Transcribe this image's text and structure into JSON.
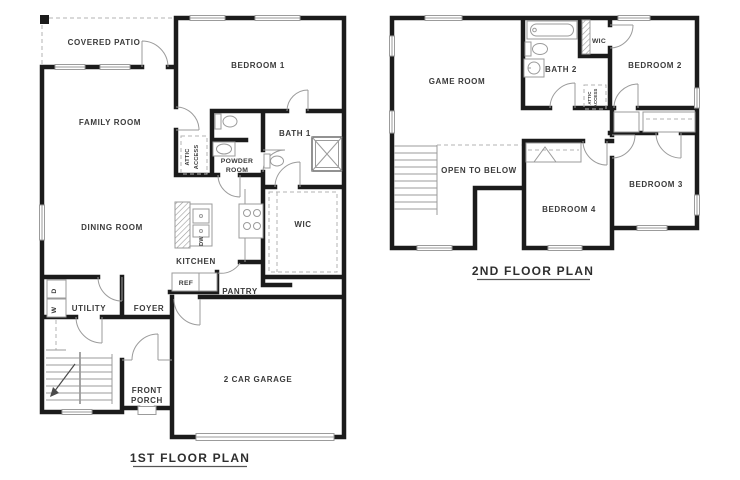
{
  "colors": {
    "wall": "#1b1b1b",
    "detail_line": "#9b9b9b",
    "dashed_line": "#b3b3b3",
    "label_text": "#3b3b3b",
    "background": "#ffffff"
  },
  "first_floor": {
    "title": "1ST FLOOR PLAN",
    "rooms": {
      "covered_patio": "COVERED PATIO",
      "bedroom1": "BEDROOM 1",
      "family_room": "FAMILY ROOM",
      "bath1": "BATH 1",
      "powder_room": [
        "POWDER",
        "ROOM"
      ],
      "attic_access": [
        "ATTIC",
        "ACCESS"
      ],
      "wic": "WIC",
      "dining_room": "DINING ROOM",
      "kitchen": "KITCHEN",
      "dishwasher": "DW",
      "refrigerator": "REF",
      "pantry": "PANTRY",
      "utility": "UTILITY",
      "dryer": "D",
      "washer": "W",
      "foyer": "FOYER",
      "front_porch": [
        "FRONT",
        "PORCH"
      ],
      "garage": "2 CAR GARAGE"
    }
  },
  "second_floor": {
    "title": "2ND FLOOR PLAN",
    "rooms": {
      "game_room": "GAME ROOM",
      "bath2": "BATH 2",
      "wic": "WIC",
      "bedroom2": "BEDROOM 2",
      "attic_access": [
        "ATTIC",
        "ACCESS"
      ],
      "open_to_below": "OPEN TO BELOW",
      "bedroom4": "BEDROOM 4",
      "bedroom3": "BEDROOM 3"
    }
  }
}
